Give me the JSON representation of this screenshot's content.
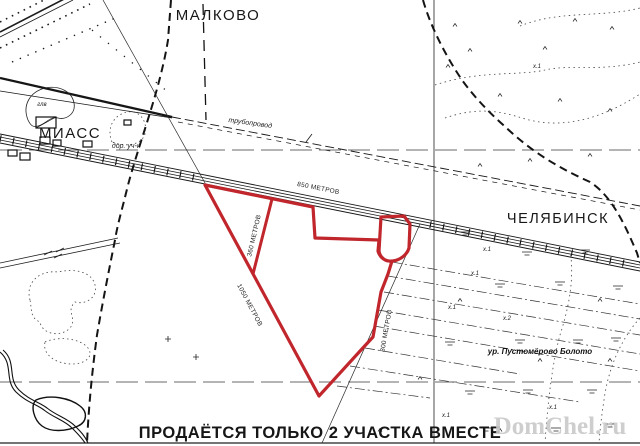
{
  "map_labels": {
    "town_top": "МАЛКОВО",
    "town_left": "МИАСС",
    "town_right": "ЧЕЛЯБИНСК",
    "pipeline": "трубопровод",
    "road_section": "дор. уч-к",
    "forest_mark": "глв",
    "swamp": "ур. Пустомёрово Болото",
    "field_mark_1": "х.1",
    "field_mark_2": "х.2"
  },
  "plot": {
    "outline_color": "#c0262c",
    "edge_top": "850 МЕТРОВ",
    "edge_inner": "360 МЕТРОВ",
    "edge_left": "1050 МЕТРОВ",
    "edge_right": "800 МЕТРОВ"
  },
  "notice": "ПРОДАЁТСЯ ТОЛЬКО 2 УЧАСТКА ВМЕСТЕ",
  "watermark": "DomChel.ru"
}
